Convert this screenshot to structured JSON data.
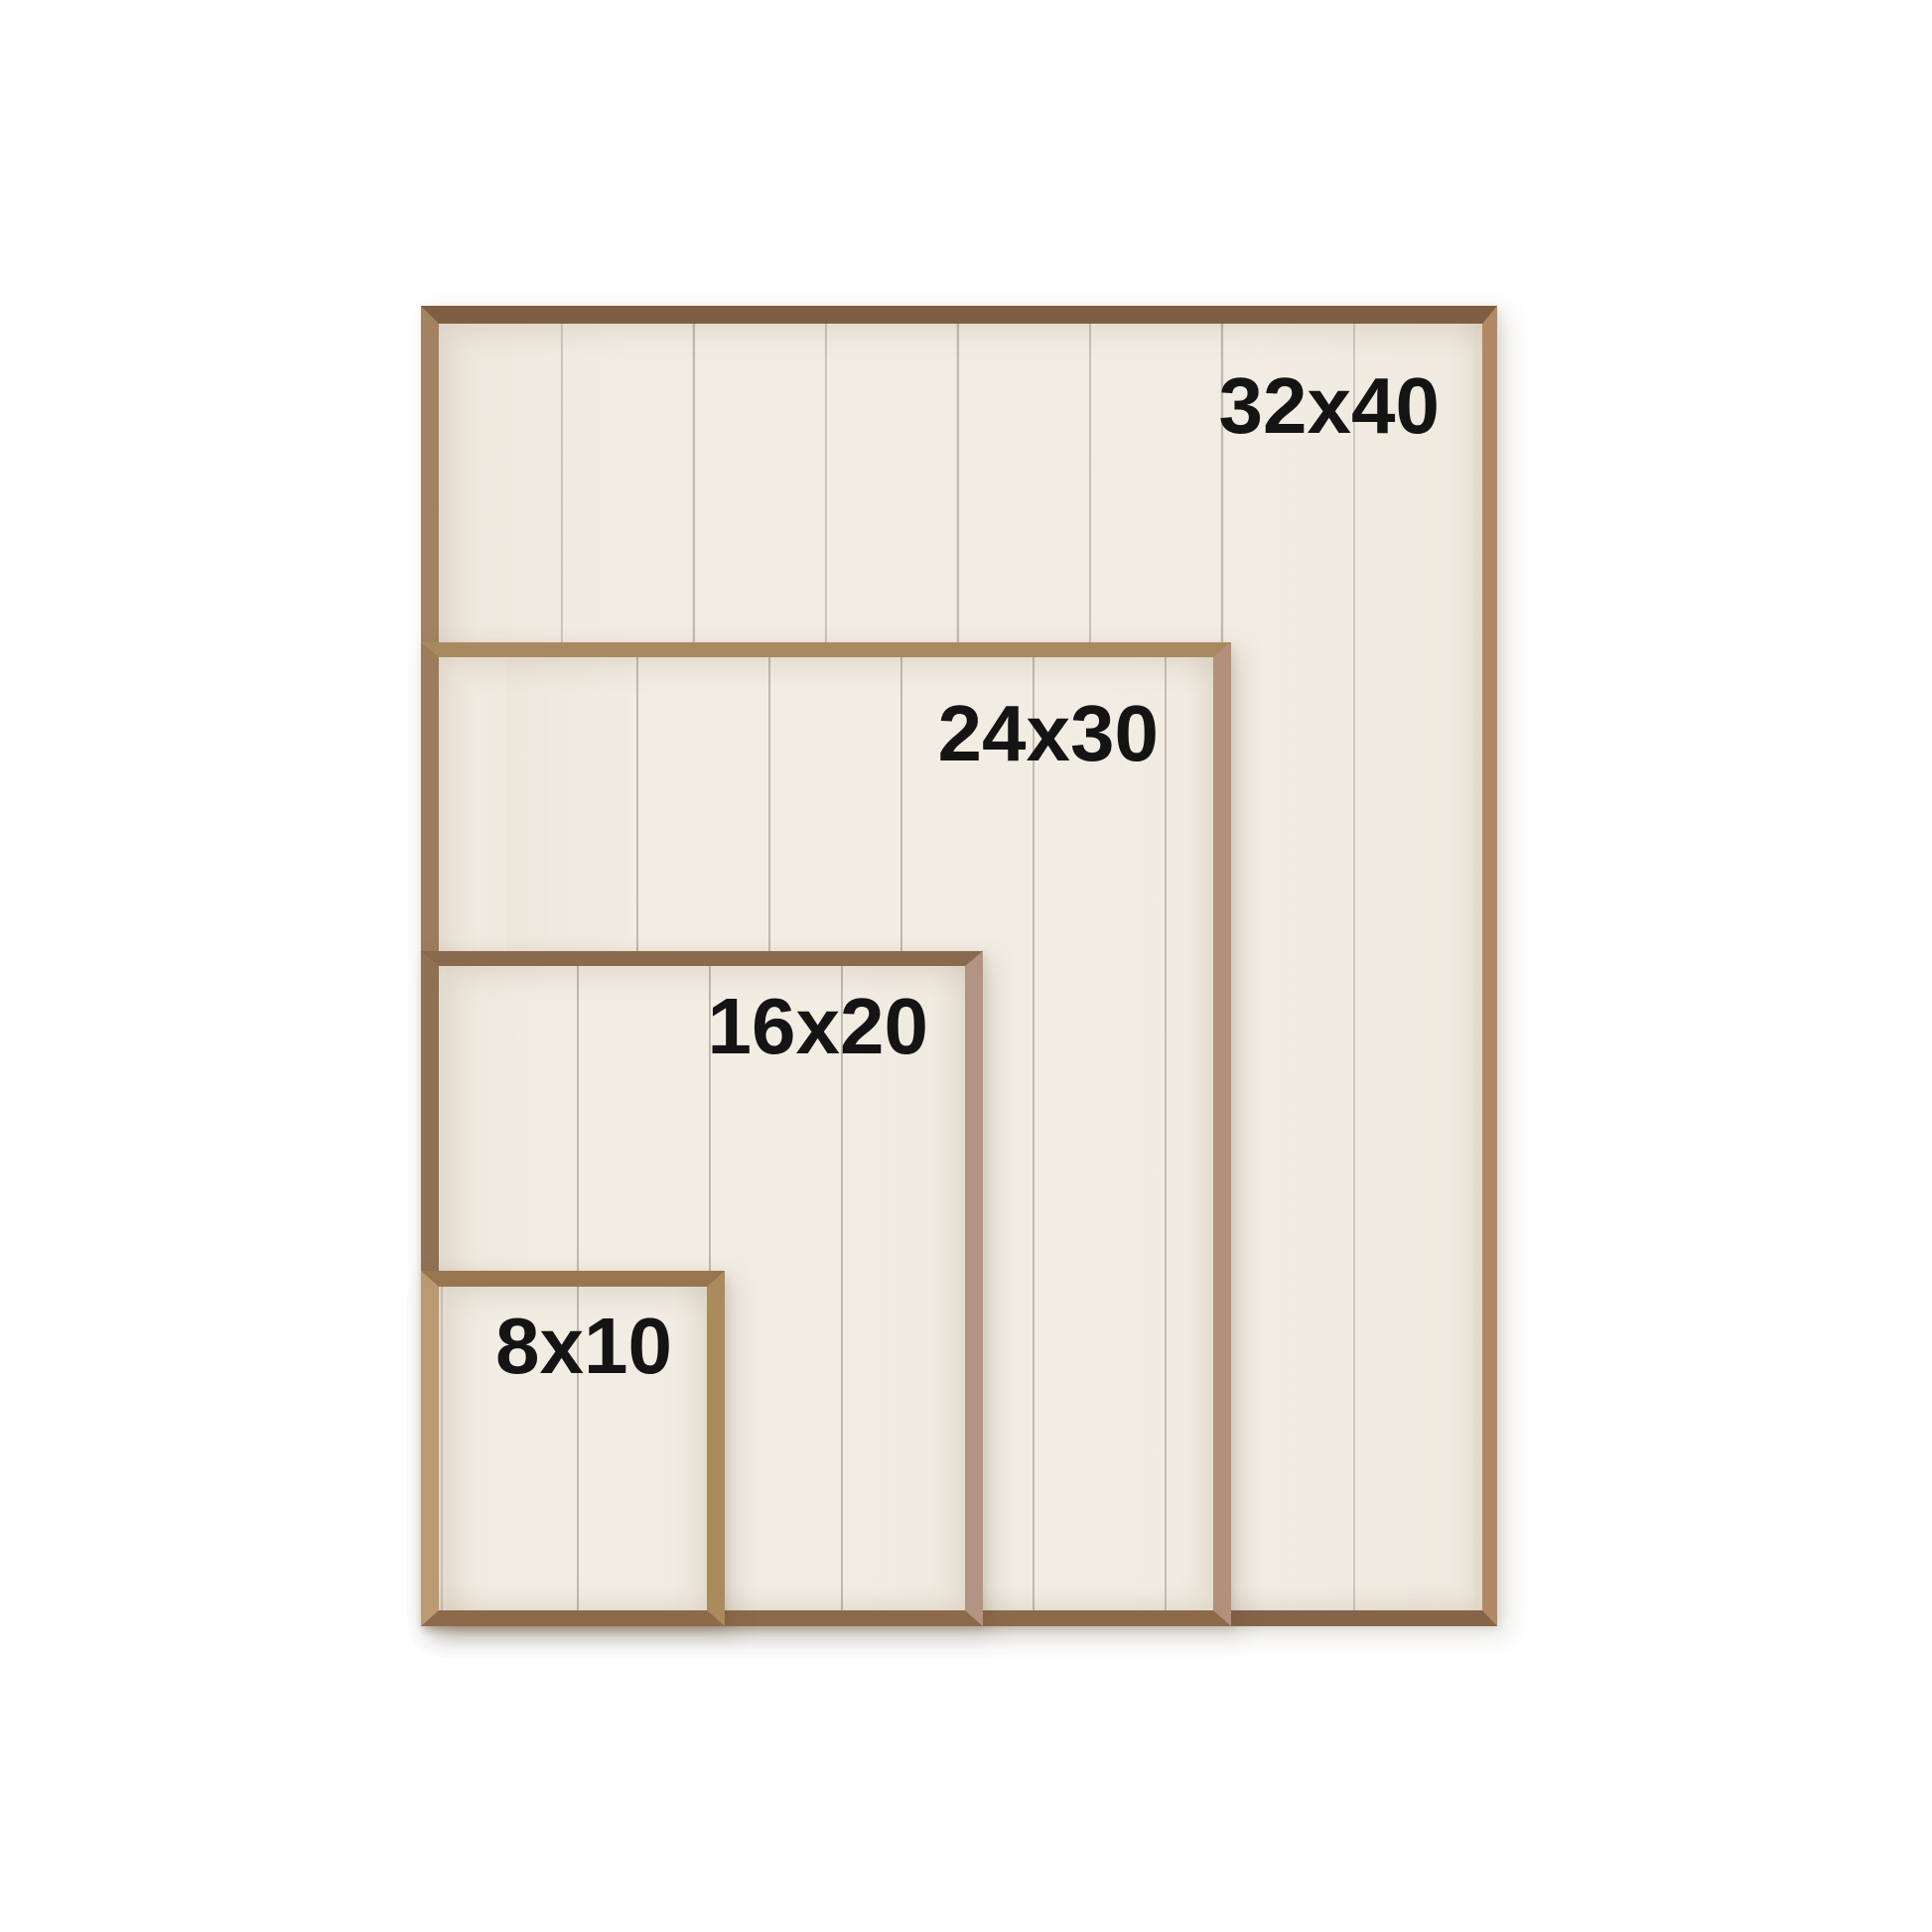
{
  "image_type": "frame-size-comparison",
  "frames": [
    {
      "label": "32x40",
      "width_in": 32,
      "height_in": 40
    },
    {
      "label": "24x30",
      "width_in": 24,
      "height_in": 30
    },
    {
      "label": "16x20",
      "width_in": 16,
      "height_in": 20
    },
    {
      "label": "8x10",
      "width_in": 8,
      "height_in": 10
    }
  ],
  "colors": {
    "background": "#ffffff",
    "panel": "#f2ede3",
    "plank_line": "#7a7264",
    "label_text": "#141414",
    "wood_dark_walnut": "#7f5e42",
    "wood_medium_brown": "#8d6a4a",
    "wood_light_oak": "#bb9a72",
    "wood_rose_tan": "#b48f7a"
  }
}
